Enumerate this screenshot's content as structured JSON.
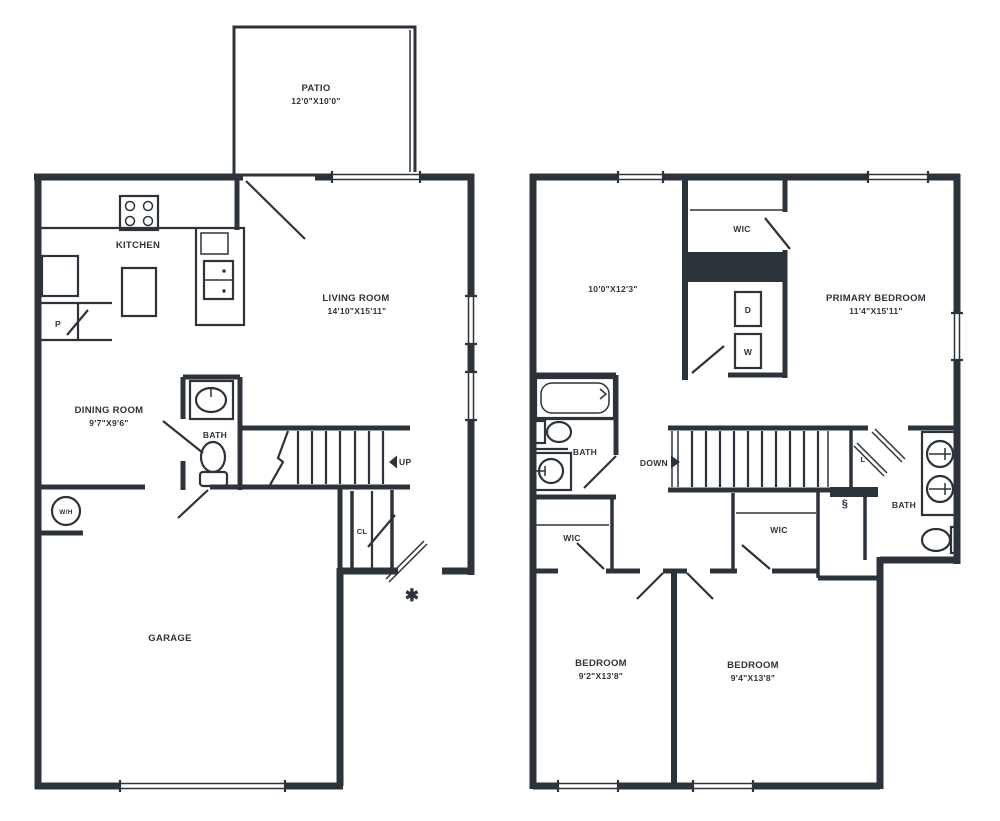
{
  "colors": {
    "line": "#2d333b",
    "background": "#ffffff"
  },
  "floor1": {
    "patio_name": "PATIO",
    "patio_dims": "12'0\"X10'0\"",
    "kitchen": "KITCHEN",
    "living_name": "LIVING ROOM",
    "living_dims": "14'10\"X15'11\"",
    "dining_name": "DINING ROOM",
    "dining_dims": "9'7\"X9'6\"",
    "bath": "BATH",
    "pantry": "P",
    "closet": "CL",
    "garage": "GARAGE",
    "water_heater": "W/H",
    "up": "UP",
    "entry_marker": "✱",
    "dryer_washer_note": ""
  },
  "floor2": {
    "room_dims": "10'0\"X12'3\"",
    "wic_top": "WIC",
    "dryer": "D",
    "washer": "W",
    "primary_name": "PRIMARY BEDROOM",
    "primary_dims": "11'4\"X15'11\"",
    "bath_left": "BATH",
    "down": "DOWN",
    "linen": "L",
    "note_symbol": "§",
    "bath_right": "BATH",
    "wic_left": "WIC",
    "wic_right": "WIC",
    "bedroom_left_name": "BEDROOM",
    "bedroom_left_dims": "9'2\"X13'8\"",
    "bedroom_right_name": "BEDROOM",
    "bedroom_right_dims": "9'4\"X13'8\""
  }
}
